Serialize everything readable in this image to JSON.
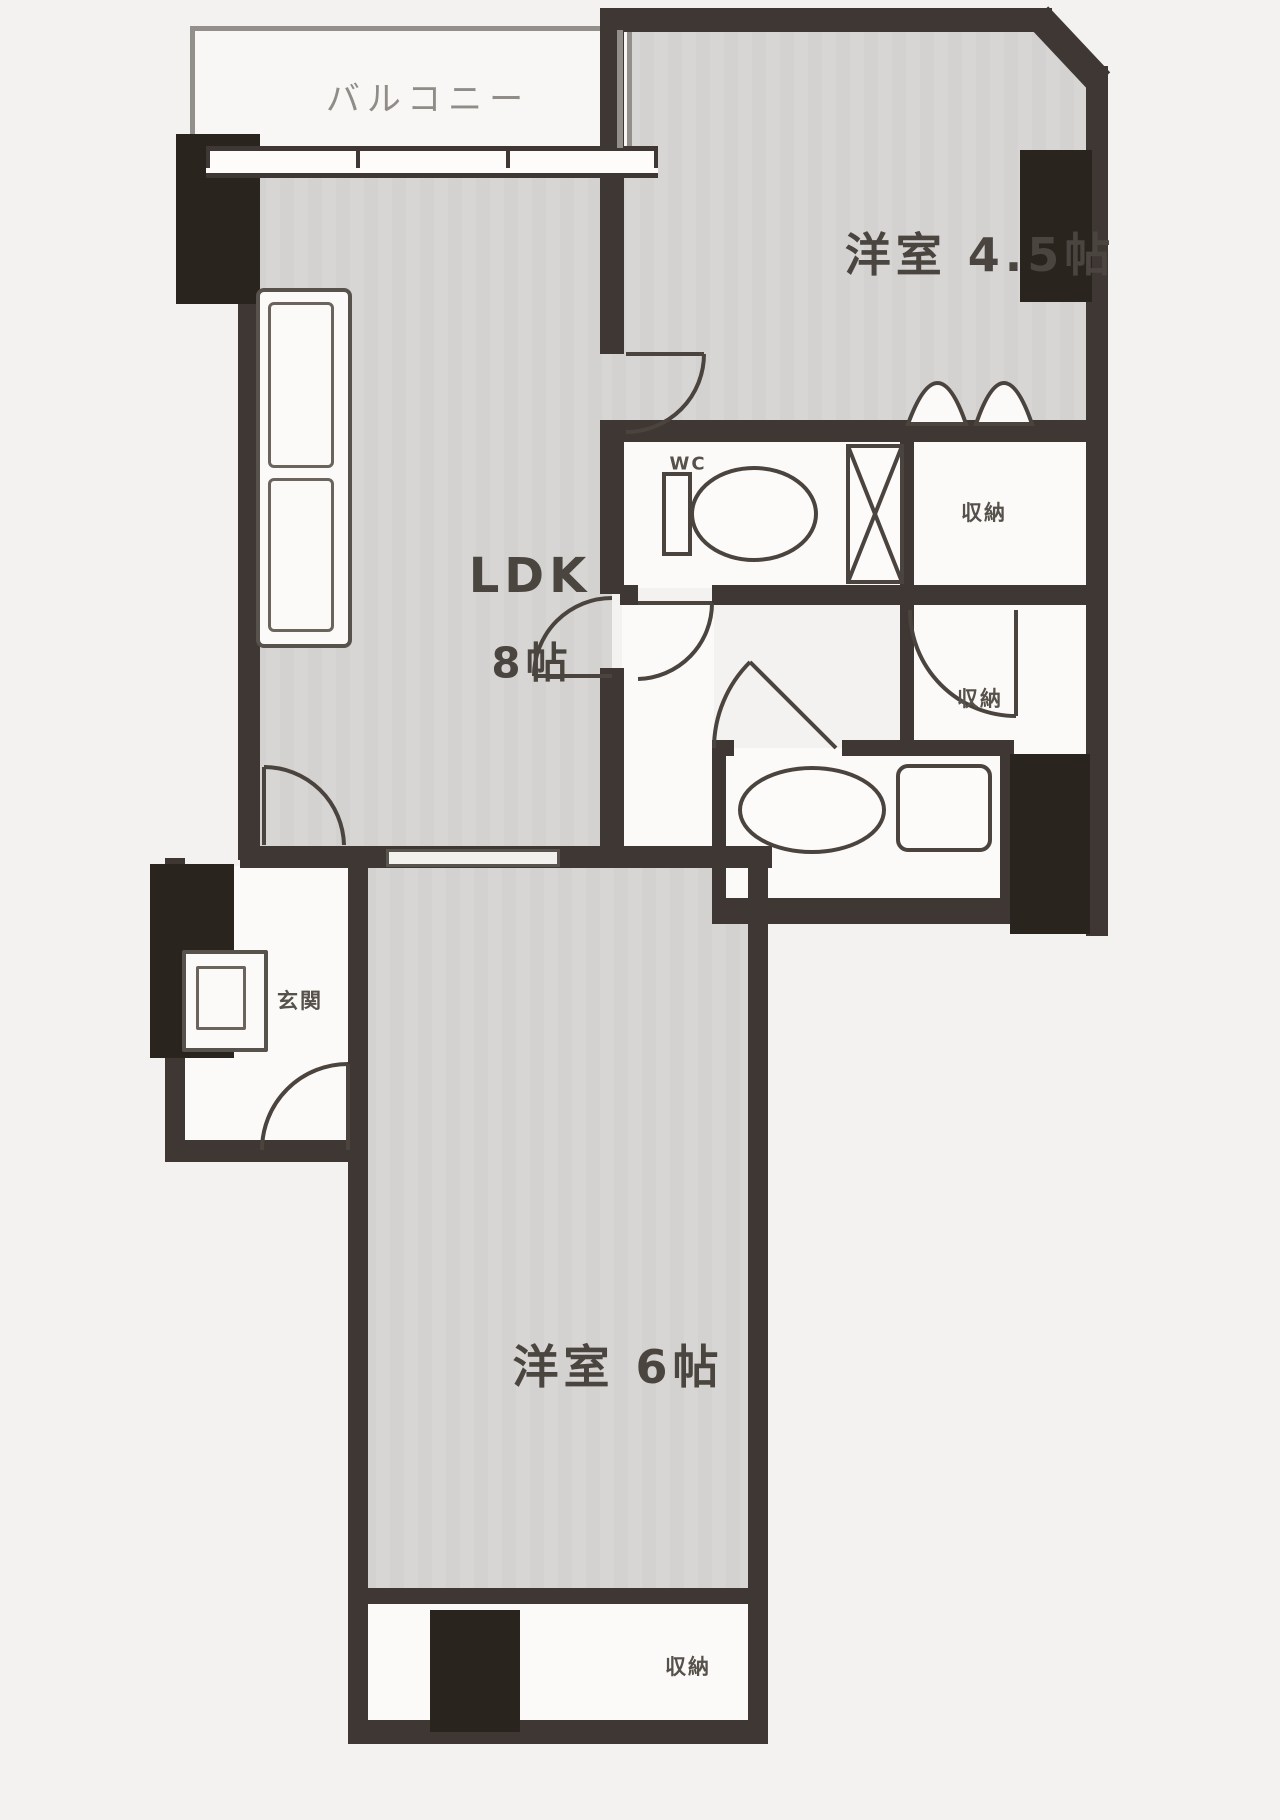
{
  "plan_title": "apartment-floor-plan",
  "colors": {
    "wall": "#3e3733",
    "pillar": "#2a241f",
    "room_fill": "#d3d2d0",
    "wet_area_fill": "#fbfaf8",
    "line": "#4a433e",
    "label": "#4b4540",
    "muted_label": "#908c87",
    "page_bg": "#f3f2f0"
  },
  "rooms": {
    "balcony": {
      "label": "バルコニー"
    },
    "western_room_45": {
      "label": "洋室 4.5帖"
    },
    "ldk": {
      "line1": "LDK",
      "line2": "8帖"
    },
    "western_room_6": {
      "label": "洋室 6帖"
    },
    "entrance": {
      "label": "玄関"
    },
    "toilet": {
      "label": "WC"
    },
    "closet_upper_right": {
      "label": "収納"
    },
    "closet_mid_right": {
      "label": "収納"
    },
    "closet_bottom": {
      "label": "収納"
    }
  }
}
